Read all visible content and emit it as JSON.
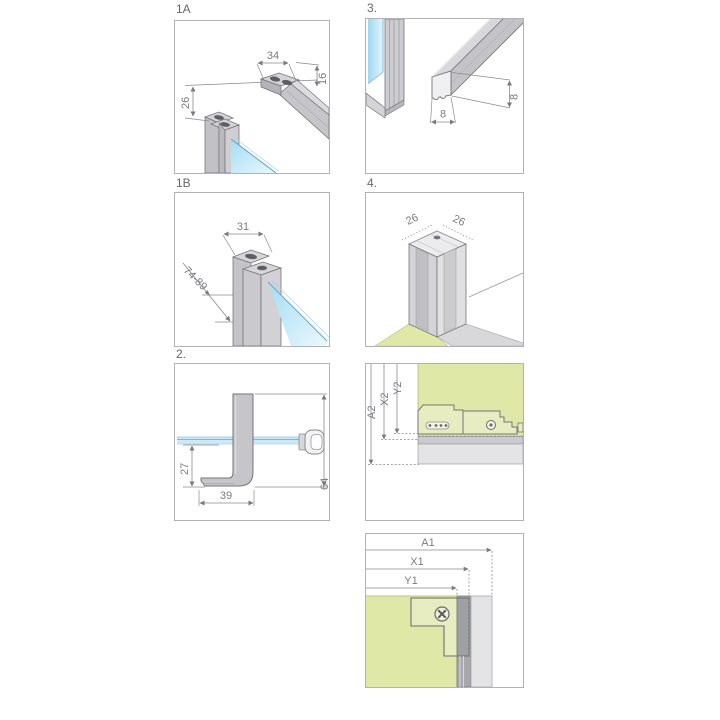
{
  "panels": {
    "p1a": {
      "label": "1A",
      "d34": "34",
      "d16": "16",
      "d26": "26"
    },
    "p3": {
      "label": "3.",
      "d8_width": "8",
      "d8_height": "8"
    },
    "p1b": {
      "label": "1B",
      "d31": "31",
      "d_range": "74-89"
    },
    "p4": {
      "label": "4.",
      "d26_left": "26",
      "d26_right": "26"
    },
    "p2": {
      "label": "2.",
      "d27": "27",
      "d39": "39",
      "d64": "64"
    },
    "p5": {
      "a2": "A2",
      "x2": "X2",
      "y2": "Y2"
    },
    "p6": {
      "a1": "A1",
      "x1": "X1",
      "y1": "Y1"
    }
  },
  "colors": {
    "glass_blue": "#bfe4f6",
    "wall_green": "#e0e8a8",
    "metal_gray": "#c6c6ca",
    "outline_gray": "#76767a",
    "dim_text_gray": "#7b7b7f",
    "panel_border": "#b2b2b6"
  }
}
